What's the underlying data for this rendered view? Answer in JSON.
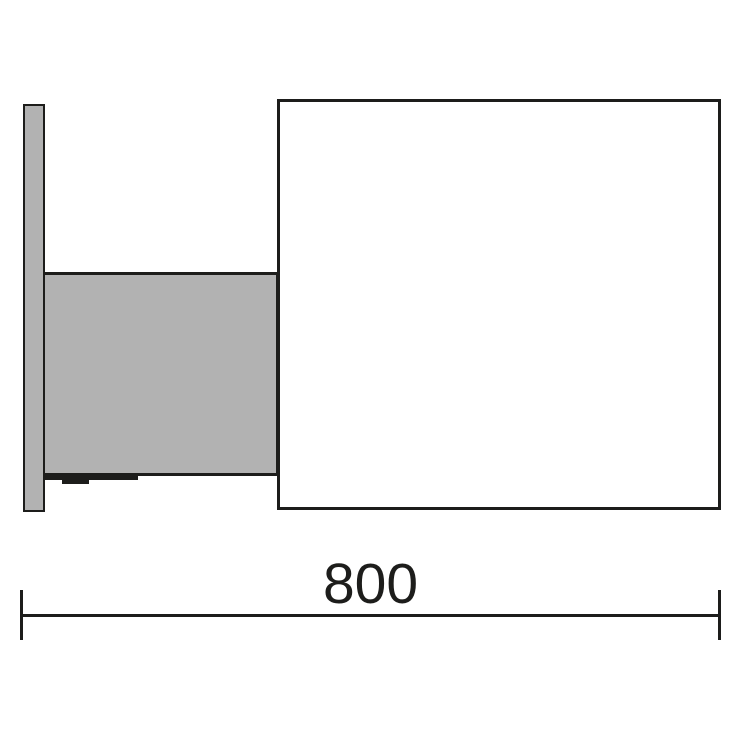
{
  "dimension": {
    "label": "800"
  },
  "colors": {
    "background": "#ffffff",
    "fill-gray": "#b2b2b2",
    "line": "#1d1d1b",
    "text": "#1d1d1b"
  }
}
